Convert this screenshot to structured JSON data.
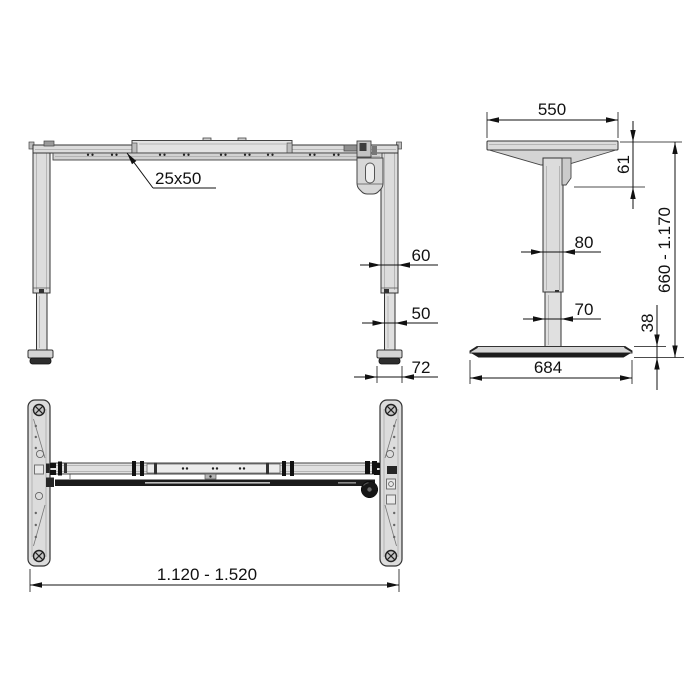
{
  "views": {
    "front": {
      "rail_section": "25x50",
      "upper_leg_width": "60",
      "lower_leg_width": "50",
      "foot_cap_width": "72"
    },
    "side": {
      "top_support_width": "550",
      "top_assembly_height": "61",
      "upper_column_width": "80",
      "lower_column_width": "70",
      "base_foot_height": "38",
      "height_range": "660 - 1.170",
      "base_foot_depth": "684"
    },
    "plan": {
      "frame_width_range": "1.120 - 1.520"
    }
  },
  "colors": {
    "line": "#1a1a1a",
    "dimension": "#111111",
    "metal_light": "#dcdcdc",
    "metal_mid": "#c8c8c8",
    "metal_dark": "#1c1c1c",
    "background": "#ffffff"
  }
}
